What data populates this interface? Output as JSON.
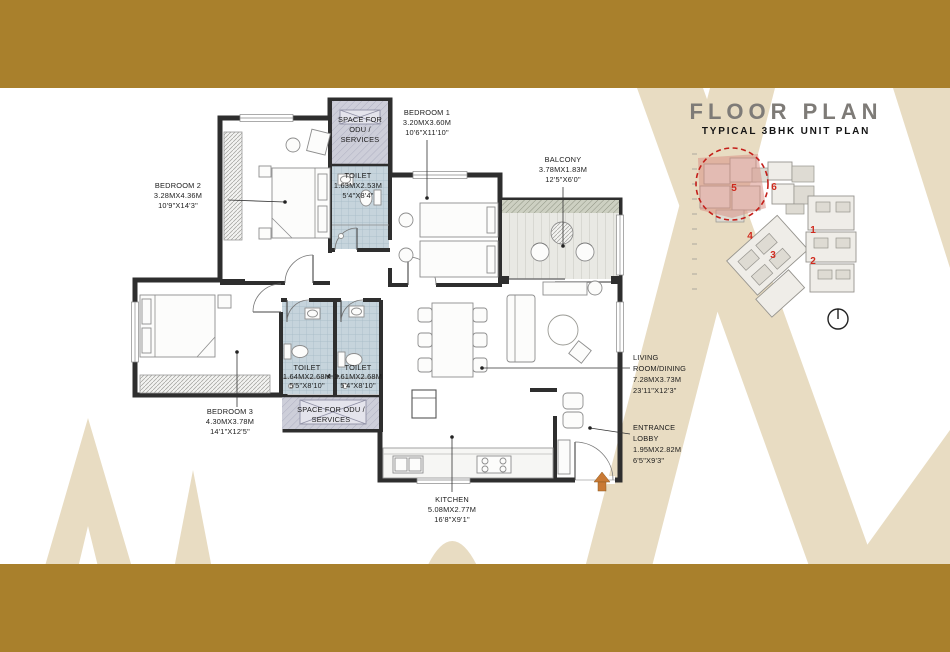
{
  "page": {
    "title": "FLOOR PLAN",
    "subtitle": "TYPICAL 3BHK UNIT PLAN"
  },
  "colors": {
    "band_brown": "#a9802c",
    "arch_beige": "#e8dcc2",
    "highlight_red": "#c41f1a",
    "toilet_tile": "#c6d4dc",
    "odu_fill": "#cdced9",
    "wall": "#2e2e2e",
    "entry_arrow_orange": "#c97a35",
    "title_gray": "#7e7b77"
  },
  "floor_plan": {
    "rooms": {
      "bedroom1": {
        "name": "BEDROOM 1",
        "dim_m": "3.20MX3.60M",
        "dim_ft": "10'6\"X11'10\""
      },
      "bedroom2": {
        "name": "BEDROOM 2",
        "dim_m": "3.28MX4.36M",
        "dim_ft": "10'9\"X14'3\""
      },
      "bedroom3": {
        "name": "BEDROOM 3",
        "dim_m": "4.30MX3.78M",
        "dim_ft": "14'1\"X12'5\""
      },
      "toilet_bedroom2": {
        "name": "TOILET",
        "dim_m": "1.63MX2.53M",
        "dim_ft": "5'4\"X8'4\""
      },
      "toilet_common": {
        "name": "TOILET",
        "dim_m": "1.64MX2.68M",
        "dim_ft": "5'5\"X8'10\""
      },
      "toilet_bedroom3": {
        "name": "TOILET",
        "dim_m": "1.61MX2.68M",
        "dim_ft": "5'4\"X8'10\""
      },
      "balcony": {
        "name": "BALCONY",
        "dim_m": "3.78MX1.83M",
        "dim_ft": "12'5\"X6'0\""
      },
      "living_dining": {
        "name_line1": "LIVING",
        "name_line2": "ROOM/DINING",
        "dim_m": "7.28MX3.73M",
        "dim_ft": "23'11\"X12'3\""
      },
      "entrance_lobby": {
        "name_line1": "ENTRANCE",
        "name_line2": "LOBBY",
        "dim_m": "1.95MX2.82M",
        "dim_ft": "6'5\"X9'3\""
      },
      "kitchen": {
        "name": "KITCHEN",
        "dim_m": "5.08MX2.77M",
        "dim_ft": "16'8\"X9'1\""
      },
      "odu_upper": {
        "line1": "SPACE FOR",
        "line2": "ODU /",
        "line3": "SERVICES"
      },
      "odu_lower": {
        "line1": "SPACE FOR ODU /",
        "line2": "SERVICES"
      }
    }
  },
  "key_plan": {
    "units": [
      "1",
      "2",
      "3",
      "4",
      "5",
      "6"
    ],
    "highlighted_unit": "5"
  },
  "icons": {
    "north_compass": "circle-with-north-pointer",
    "entry_arrow": "orange-up-arrow"
  }
}
